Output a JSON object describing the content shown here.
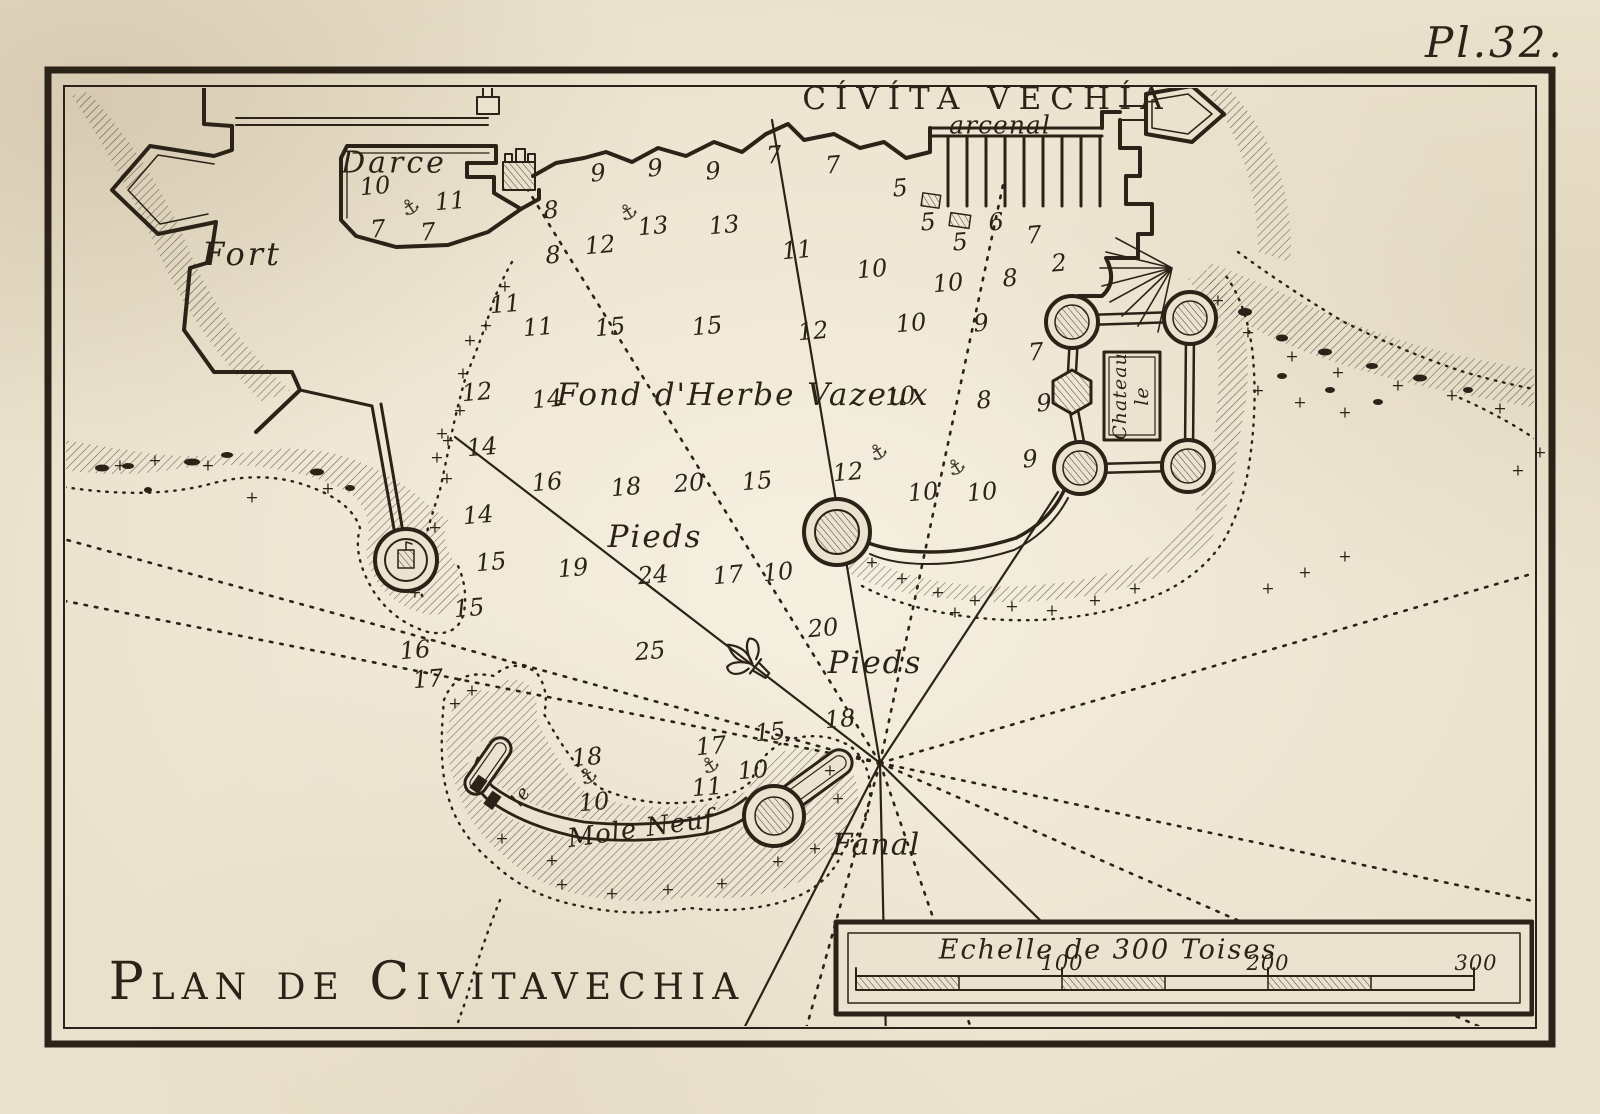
{
  "plate_label": "Pl.32.",
  "ink_color": "#2b2317",
  "paper_color": "#eae1cc",
  "labels": {
    "city_title": "Cívíta Vechía",
    "arsenal": "arcenal",
    "darce": "Darce",
    "fort": "Fort",
    "seabed": "Fond d'Herbe Vazeux",
    "pieds_upper": "Pieds",
    "pieds_lower": "Pieds",
    "chateau_line1": "Chateau",
    "chateau_line2": "le",
    "mole_neuf": "Mole Neuf",
    "mole_le": "le",
    "fanal": "Fanal",
    "main_title": "Plan de Civitavechia"
  },
  "scale_bar": {
    "caption": "Echelle de 300 Toises",
    "ticks": [
      "100",
      "200",
      "300"
    ]
  },
  "soundings": [
    {
      "v": "10",
      "x": 375,
      "y": 186
    },
    {
      "v": "11",
      "x": 450,
      "y": 201
    },
    {
      "v": "7",
      "x": 378,
      "y": 229
    },
    {
      "v": "7",
      "x": 428,
      "y": 232
    },
    {
      "v": "9",
      "x": 598,
      "y": 173
    },
    {
      "v": "9",
      "x": 655,
      "y": 168
    },
    {
      "v": "9",
      "x": 713,
      "y": 171
    },
    {
      "v": "7",
      "x": 774,
      "y": 155
    },
    {
      "v": "7",
      "x": 833,
      "y": 165
    },
    {
      "v": "5",
      "x": 900,
      "y": 188
    },
    {
      "v": "8",
      "x": 551,
      "y": 210
    },
    {
      "v": "8",
      "x": 553,
      "y": 255
    },
    {
      "v": "12",
      "x": 600,
      "y": 245
    },
    {
      "v": "13",
      "x": 653,
      "y": 226
    },
    {
      "v": "13",
      "x": 724,
      "y": 225
    },
    {
      "v": "11",
      "x": 797,
      "y": 250
    },
    {
      "v": "5",
      "x": 928,
      "y": 222
    },
    {
      "v": "5",
      "x": 960,
      "y": 242
    },
    {
      "v": "6",
      "x": 996,
      "y": 222
    },
    {
      "v": "7",
      "x": 1034,
      "y": 235
    },
    {
      "v": "2",
      "x": 1059,
      "y": 263
    },
    {
      "v": "8",
      "x": 1010,
      "y": 278
    },
    {
      "v": "10",
      "x": 872,
      "y": 269
    },
    {
      "v": "10",
      "x": 948,
      "y": 283
    },
    {
      "v": "10",
      "x": 911,
      "y": 323
    },
    {
      "v": "9",
      "x": 981,
      "y": 323
    },
    {
      "v": "7",
      "x": 1036,
      "y": 352
    },
    {
      "v": "8",
      "x": 984,
      "y": 400
    },
    {
      "v": "9",
      "x": 1044,
      "y": 403
    },
    {
      "v": "9",
      "x": 1030,
      "y": 459
    },
    {
      "v": "10",
      "x": 923,
      "y": 492
    },
    {
      "v": "10",
      "x": 982,
      "y": 492
    },
    {
      "v": "11",
      "x": 505,
      "y": 304
    },
    {
      "v": "11",
      "x": 538,
      "y": 327
    },
    {
      "v": "15",
      "x": 610,
      "y": 327
    },
    {
      "v": "15",
      "x": 707,
      "y": 326
    },
    {
      "v": "12",
      "x": 813,
      "y": 331
    },
    {
      "v": "12",
      "x": 477,
      "y": 392
    },
    {
      "v": "14",
      "x": 547,
      "y": 399
    },
    {
      "v": "10",
      "x": 900,
      "y": 396
    },
    {
      "v": "14",
      "x": 482,
      "y": 447
    },
    {
      "v": "16",
      "x": 547,
      "y": 482
    },
    {
      "v": "18",
      "x": 626,
      "y": 487
    },
    {
      "v": "20",
      "x": 689,
      "y": 483
    },
    {
      "v": "15",
      "x": 757,
      "y": 481
    },
    {
      "v": "14",
      "x": 478,
      "y": 515
    },
    {
      "v": "15",
      "x": 491,
      "y": 562
    },
    {
      "v": "15",
      "x": 469,
      "y": 608
    },
    {
      "v": "16",
      "x": 415,
      "y": 650
    },
    {
      "v": "17",
      "x": 428,
      "y": 679
    },
    {
      "v": "19",
      "x": 573,
      "y": 568
    },
    {
      "v": "24",
      "x": 653,
      "y": 575
    },
    {
      "v": "17",
      "x": 728,
      "y": 575
    },
    {
      "v": "25",
      "x": 650,
      "y": 651
    },
    {
      "v": "10",
      "x": 778,
      "y": 572
    },
    {
      "v": "12",
      "x": 848,
      "y": 472
    },
    {
      "v": "20",
      "x": 823,
      "y": 628
    },
    {
      "v": "18",
      "x": 587,
      "y": 757
    },
    {
      "v": "10",
      "x": 594,
      "y": 802
    },
    {
      "v": "17",
      "x": 711,
      "y": 746
    },
    {
      "v": "11",
      "x": 707,
      "y": 787
    },
    {
      "v": "10",
      "x": 753,
      "y": 770
    },
    {
      "v": "15",
      "x": 770,
      "y": 732
    },
    {
      "v": "18",
      "x": 840,
      "y": 719
    }
  ],
  "anchors": [
    {
      "x": 410,
      "y": 207
    },
    {
      "x": 628,
      "y": 212
    },
    {
      "x": 878,
      "y": 452
    },
    {
      "x": 956,
      "y": 467
    },
    {
      "x": 588,
      "y": 776
    },
    {
      "x": 710,
      "y": 765
    }
  ],
  "rocks": [
    {
      "x": 120,
      "y": 465
    },
    {
      "x": 155,
      "y": 460
    },
    {
      "x": 208,
      "y": 465
    },
    {
      "x": 252,
      "y": 497
    },
    {
      "x": 328,
      "y": 488
    },
    {
      "x": 442,
      "y": 433
    },
    {
      "x": 437,
      "y": 457
    },
    {
      "x": 447,
      "y": 478
    },
    {
      "x": 435,
      "y": 527
    },
    {
      "x": 415,
      "y": 592
    },
    {
      "x": 470,
      "y": 340
    },
    {
      "x": 486,
      "y": 325
    },
    {
      "x": 505,
      "y": 286
    },
    {
      "x": 463,
      "y": 373
    },
    {
      "x": 460,
      "y": 410
    },
    {
      "x": 448,
      "y": 440
    },
    {
      "x": 455,
      "y": 703
    },
    {
      "x": 472,
      "y": 690
    },
    {
      "x": 562,
      "y": 884
    },
    {
      "x": 612,
      "y": 893
    },
    {
      "x": 668,
      "y": 889
    },
    {
      "x": 722,
      "y": 883
    },
    {
      "x": 778,
      "y": 861
    },
    {
      "x": 815,
      "y": 848
    },
    {
      "x": 838,
      "y": 798
    },
    {
      "x": 830,
      "y": 770
    },
    {
      "x": 552,
      "y": 860
    },
    {
      "x": 502,
      "y": 838
    },
    {
      "x": 872,
      "y": 562
    },
    {
      "x": 902,
      "y": 578
    },
    {
      "x": 938,
      "y": 592
    },
    {
      "x": 975,
      "y": 600
    },
    {
      "x": 1012,
      "y": 606
    },
    {
      "x": 1052,
      "y": 610
    },
    {
      "x": 1095,
      "y": 600
    },
    {
      "x": 1135,
      "y": 588
    },
    {
      "x": 955,
      "y": 612
    },
    {
      "x": 1248,
      "y": 332
    },
    {
      "x": 1292,
      "y": 356
    },
    {
      "x": 1338,
      "y": 372
    },
    {
      "x": 1398,
      "y": 385
    },
    {
      "x": 1452,
      "y": 395
    },
    {
      "x": 1500,
      "y": 408
    },
    {
      "x": 1540,
      "y": 452
    },
    {
      "x": 1518,
      "y": 470
    },
    {
      "x": 1258,
      "y": 390
    },
    {
      "x": 1300,
      "y": 402
    },
    {
      "x": 1345,
      "y": 412
    },
    {
      "x": 1268,
      "y": 588
    },
    {
      "x": 1305,
      "y": 572
    },
    {
      "x": 1345,
      "y": 556
    },
    {
      "x": 1218,
      "y": 300
    }
  ]
}
